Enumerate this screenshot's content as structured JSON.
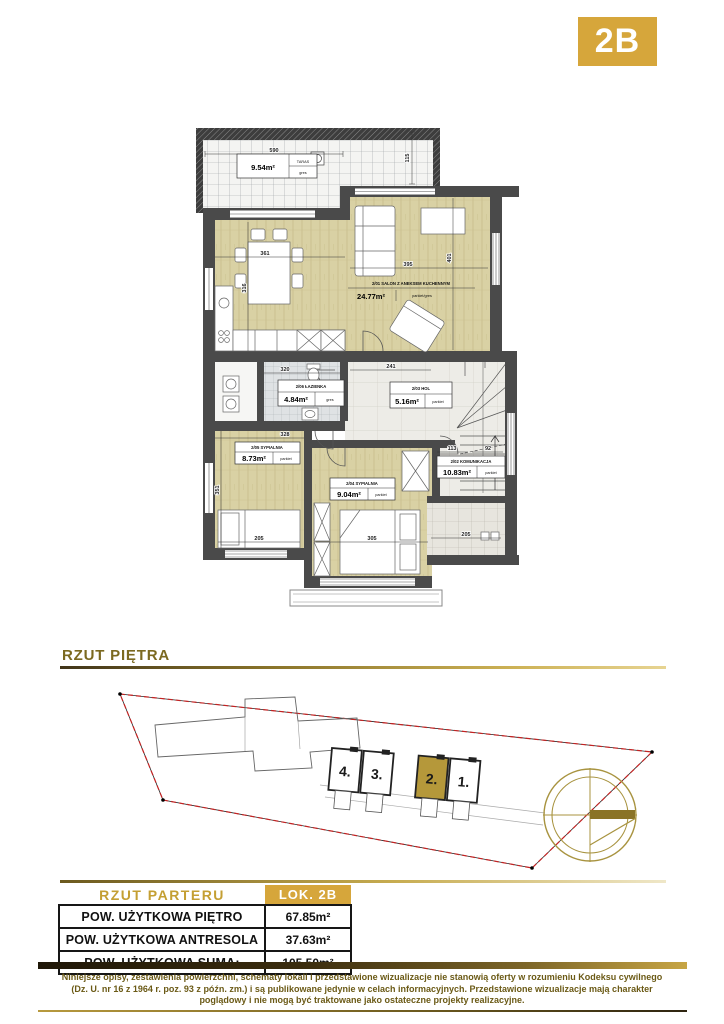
{
  "badge": "2B",
  "section": {
    "title": "RZUT PIĘTRA"
  },
  "plan": {
    "rooms": {
      "taras": {
        "name": "TARAS",
        "area": "9.54m²",
        "floor": "gres"
      },
      "salon": {
        "code_name": "2/01  SALON Z ANEKSEM KUCHENNYM",
        "area": "24.77m²",
        "floor": "parkiet/gres"
      },
      "lazienka": {
        "code_name": "2/06  ŁAZIENKA",
        "area": "4.84m²",
        "floor": "gres"
      },
      "hol": {
        "code_name": "2/03  HOL",
        "area": "5.16m²",
        "floor": "parkiet"
      },
      "sypialnia_1": {
        "code_name": "2/05  SYPIALNIA",
        "area": "8.73m²",
        "floor": "parkiet"
      },
      "sypialnia_2": {
        "code_name": "2/04  SYPIALNIA",
        "area": "9.04m²",
        "floor": "parkiet"
      },
      "komunikacja": {
        "code_name": "2/02  KOMUNIKACJA",
        "area": "10.83m²",
        "floor": "parkiet"
      }
    },
    "dims": {
      "taras_w": "590",
      "taras_h": "115",
      "dining_w": "361",
      "dining_h": "316",
      "salon_w": "395",
      "salon_h": "401",
      "lazienka_w": "320",
      "hol_w": "241",
      "syp1_w": "328",
      "syp1_h": "351",
      "kom_w1": "113",
      "kom_w2": "92",
      "syp1_b": "205",
      "syp2_b": "305",
      "taras2_b": "205"
    }
  },
  "siteplan": {
    "units": [
      "4.",
      "3.",
      "2.",
      "1."
    ]
  },
  "table": {
    "header_left": "RZUT PARTERU",
    "header_right": "LOK. 2B",
    "rows": [
      {
        "label": "POW. UŻYTKOWA PIĘTRO",
        "value": "67.85m²"
      },
      {
        "label": "POW. UŻYTKOWA ANTRESOLA",
        "value": "37.63m²"
      },
      {
        "label": "POW. UŻYTKOWA SUMA:",
        "value": "105.50m²"
      }
    ]
  },
  "disclaimer": {
    "line1": "Niniejsze opisy, zestawienia powierzchni, schematy lokali i przedstawione wizualizacje nie stanowią oferty w rozumieniu Kodeksu cywilnego",
    "line2": "(Dz. U. nr 16 z 1964 r. poz. 93 z późn. zm.) i są publikowane jedynie w celach informacyjnych. Przedstawione wizualizacje mają charakter",
    "line3": "poglądowy i nie mogą być traktowane jako ostateczne projekty realizacyjne."
  },
  "colors": {
    "gold": "#D6A63B",
    "olive_text": "#7B6920",
    "unit_highlight": "#B5983A",
    "boundary_red": "#C42222"
  }
}
